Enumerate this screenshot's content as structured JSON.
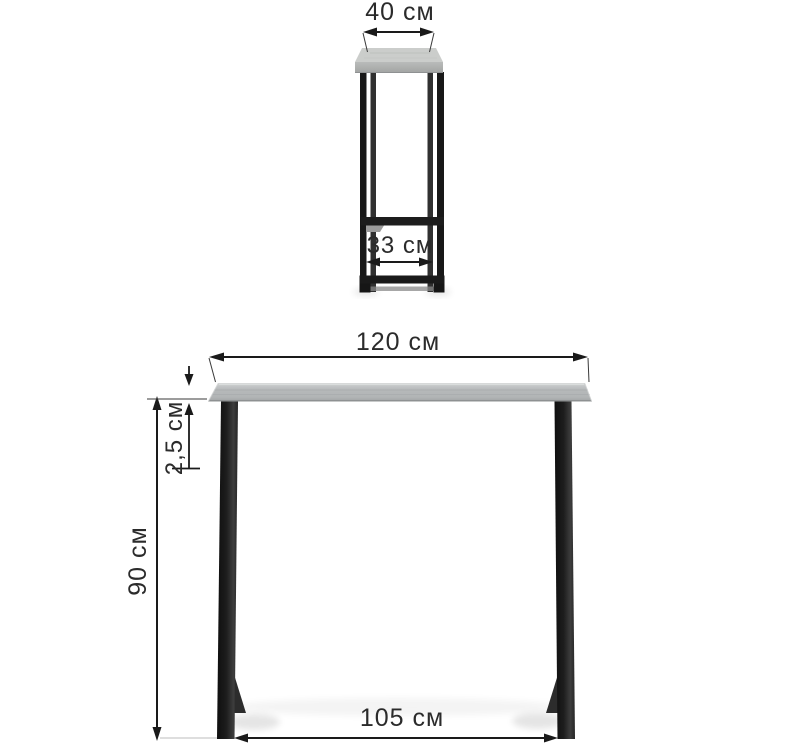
{
  "page": {
    "background_color": "#ffffff",
    "description": "Furniture dimension diagram of a black-metal bar console table with gray wood top, shown in side view (top figure) and front view (bottom figure)",
    "units": "см"
  },
  "colors": {
    "dimension_line": "#1a1a1a",
    "label_text": "#2b2b2b",
    "metal_frame_dark": "#161616",
    "metal_frame_light": "#3c3c3c",
    "tabletop_top_face": "#cbcdcb",
    "tabletop_front_face": "#b6b9ba",
    "shadow": "#000000"
  },
  "views": {
    "side_view": {
      "name": "side view",
      "dimensions": {
        "top_depth": {
          "label": "40 см",
          "value_cm": 40
        },
        "inner_depth": {
          "label": "33 см",
          "value_cm": 33
        }
      }
    },
    "front_view": {
      "name": "front view",
      "dimensions": {
        "top_length": {
          "label": "120 см",
          "value_cm": 120
        },
        "top_thickness": {
          "label": "2,5 см",
          "value_cm": 2.5
        },
        "height": {
          "label": "90 см",
          "value_cm": 90
        },
        "leg_inner_span": {
          "label": "105 см",
          "value_cm": 105
        }
      }
    }
  }
}
